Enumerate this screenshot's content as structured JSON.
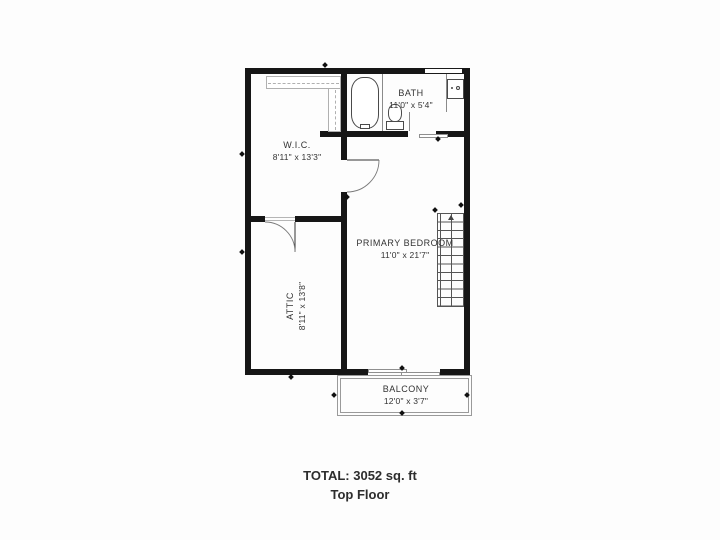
{
  "floorplan": {
    "rooms": {
      "wic": {
        "name": "W.I.C.",
        "dims": "8'11\" x 13'3\""
      },
      "bath": {
        "name": "BATH",
        "dims": "11'0\" x 5'4\""
      },
      "primary_bedroom": {
        "name": "PRIMARY BEDROOM",
        "dims": "11'0\" x 21'7\""
      },
      "attic": {
        "name": "ATTIC",
        "dims": "8'11\" x 13'8\""
      },
      "balcony": {
        "name": "BALCONY",
        "dims": "12'0\" x 3'7\""
      }
    },
    "footer": {
      "total": "TOTAL: 3052 sq. ft",
      "floor": "Top Floor"
    },
    "colors": {
      "wall": "#161616",
      "fixture_line": "#4a4a4a",
      "text": "#333333"
    }
  }
}
